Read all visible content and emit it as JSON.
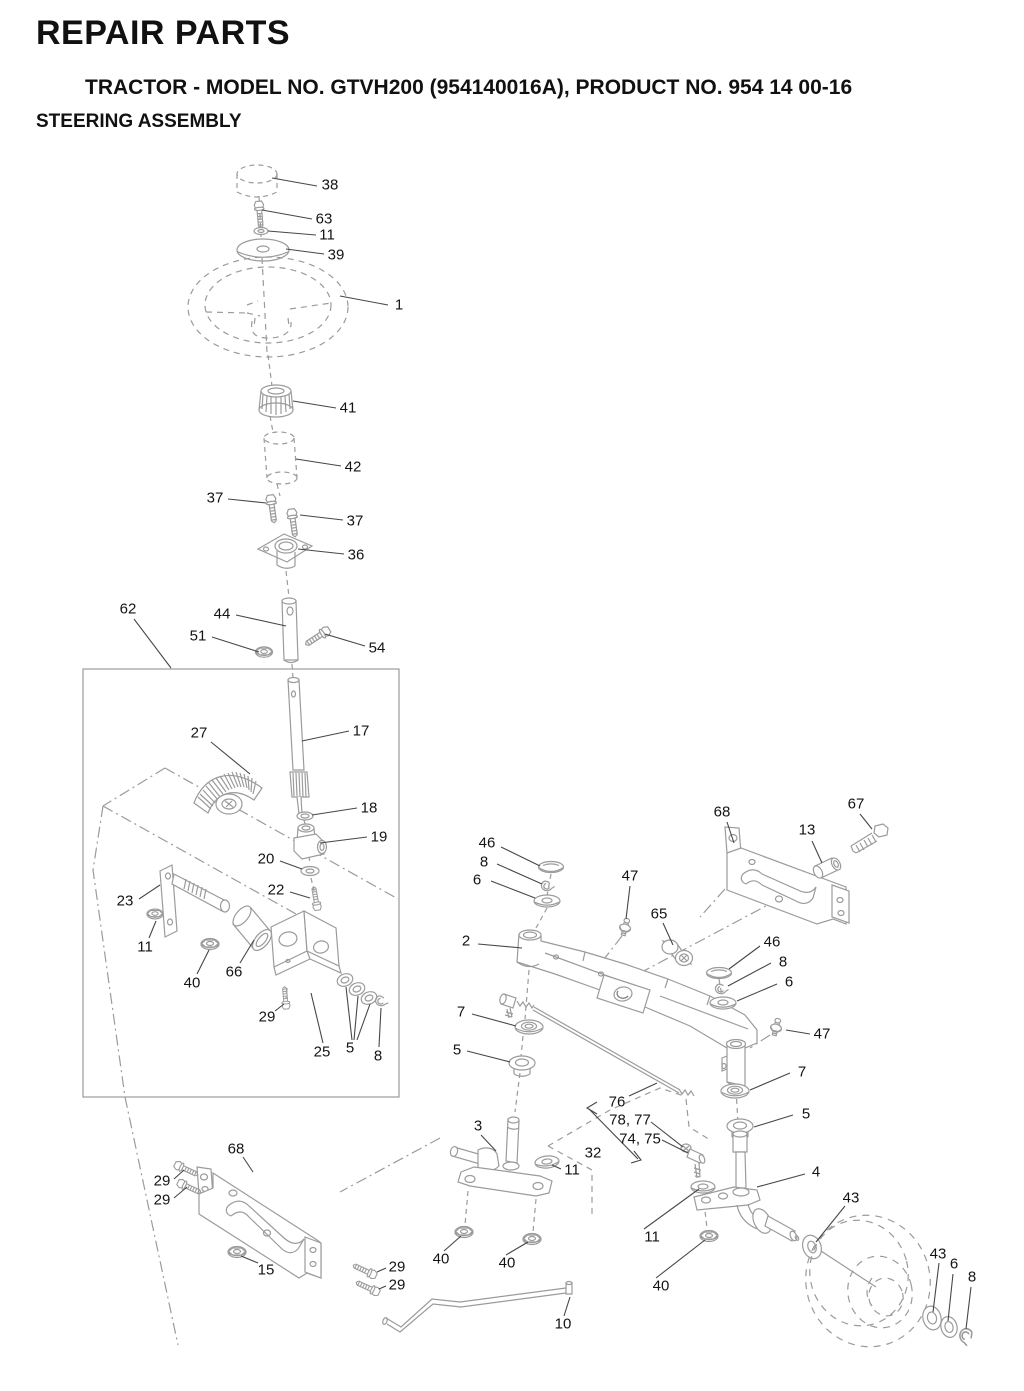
{
  "header": {
    "title": "REPAIR PARTS",
    "subtitle": "TRACTOR - MODEL NO. GTVH200 (954140016A), PRODUCT NO. 954 14 00-16",
    "section": "STEERING ASSEMBLY"
  },
  "diagram": {
    "description": "Exploded view of steering assembly with numbered part callouts",
    "art_color": "#9b9b9b",
    "leader_color": "#474747",
    "label_color": "#141414",
    "callouts": [
      {
        "text": "38",
        "x": 330,
        "y": 185
      },
      {
        "text": "63",
        "x": 324,
        "y": 219
      },
      {
        "text": "11",
        "x": 327,
        "y": 235
      },
      {
        "text": "39",
        "x": 336,
        "y": 255
      },
      {
        "text": "1",
        "x": 399,
        "y": 305
      },
      {
        "text": "41",
        "x": 348,
        "y": 408
      },
      {
        "text": "42",
        "x": 353,
        "y": 467
      },
      {
        "text": "37",
        "x": 215,
        "y": 498
      },
      {
        "text": "37",
        "x": 355,
        "y": 521
      },
      {
        "text": "36",
        "x": 356,
        "y": 555
      },
      {
        "text": "62",
        "x": 128,
        "y": 609
      },
      {
        "text": "44",
        "x": 222,
        "y": 614
      },
      {
        "text": "51",
        "x": 198,
        "y": 636
      },
      {
        "text": "54",
        "x": 377,
        "y": 648
      },
      {
        "text": "17",
        "x": 361,
        "y": 731
      },
      {
        "text": "27",
        "x": 199,
        "y": 733
      },
      {
        "text": "18",
        "x": 369,
        "y": 808
      },
      {
        "text": "19",
        "x": 379,
        "y": 837
      },
      {
        "text": "20",
        "x": 266,
        "y": 859
      },
      {
        "text": "22",
        "x": 276,
        "y": 890
      },
      {
        "text": "23",
        "x": 125,
        "y": 901
      },
      {
        "text": "11",
        "x": 145,
        "y": 947
      },
      {
        "text": "40",
        "x": 192,
        "y": 983
      },
      {
        "text": "66",
        "x": 234,
        "y": 972
      },
      {
        "text": "29",
        "x": 267,
        "y": 1017
      },
      {
        "text": "25",
        "x": 322,
        "y": 1052
      },
      {
        "text": "5",
        "x": 350,
        "y": 1048
      },
      {
        "text": "8",
        "x": 378,
        "y": 1056
      },
      {
        "text": "68",
        "x": 722,
        "y": 812
      },
      {
        "text": "13",
        "x": 807,
        "y": 830
      },
      {
        "text": "67",
        "x": 856,
        "y": 804
      },
      {
        "text": "46",
        "x": 487,
        "y": 843
      },
      {
        "text": "8",
        "x": 484,
        "y": 862
      },
      {
        "text": "6",
        "x": 477,
        "y": 880
      },
      {
        "text": "47",
        "x": 630,
        "y": 876
      },
      {
        "text": "65",
        "x": 659,
        "y": 914
      },
      {
        "text": "2",
        "x": 466,
        "y": 941
      },
      {
        "text": "46",
        "x": 772,
        "y": 942
      },
      {
        "text": "8",
        "x": 783,
        "y": 962
      },
      {
        "text": "6",
        "x": 789,
        "y": 982
      },
      {
        "text": "47",
        "x": 822,
        "y": 1034
      },
      {
        "text": "7",
        "x": 461,
        "y": 1012
      },
      {
        "text": "5",
        "x": 457,
        "y": 1050
      },
      {
        "text": "7",
        "x": 802,
        "y": 1072
      },
      {
        "text": "5",
        "x": 806,
        "y": 1114
      },
      {
        "text": "76",
        "x": 617,
        "y": 1102
      },
      {
        "text": "78, 77",
        "x": 630,
        "y": 1120
      },
      {
        "text": "74, 75",
        "x": 640,
        "y": 1139
      },
      {
        "text": "32",
        "x": 593,
        "y": 1153
      },
      {
        "text": "3",
        "x": 478,
        "y": 1126
      },
      {
        "text": "11",
        "x": 572,
        "y": 1170
      },
      {
        "text": "4",
        "x": 816,
        "y": 1172
      },
      {
        "text": "68",
        "x": 236,
        "y": 1149
      },
      {
        "text": "29",
        "x": 162,
        "y": 1181
      },
      {
        "text": "29",
        "x": 162,
        "y": 1200
      },
      {
        "text": "15",
        "x": 266,
        "y": 1270
      },
      {
        "text": "29",
        "x": 397,
        "y": 1267
      },
      {
        "text": "29",
        "x": 397,
        "y": 1285
      },
      {
        "text": "40",
        "x": 441,
        "y": 1259
      },
      {
        "text": "40",
        "x": 507,
        "y": 1263
      },
      {
        "text": "10",
        "x": 563,
        "y": 1324
      },
      {
        "text": "11",
        "x": 652,
        "y": 1237
      },
      {
        "text": "40",
        "x": 661,
        "y": 1286
      },
      {
        "text": "43",
        "x": 851,
        "y": 1198
      },
      {
        "text": "43",
        "x": 938,
        "y": 1254
      },
      {
        "text": "6",
        "x": 954,
        "y": 1264
      },
      {
        "text": "8",
        "x": 972,
        "y": 1277
      }
    ]
  }
}
